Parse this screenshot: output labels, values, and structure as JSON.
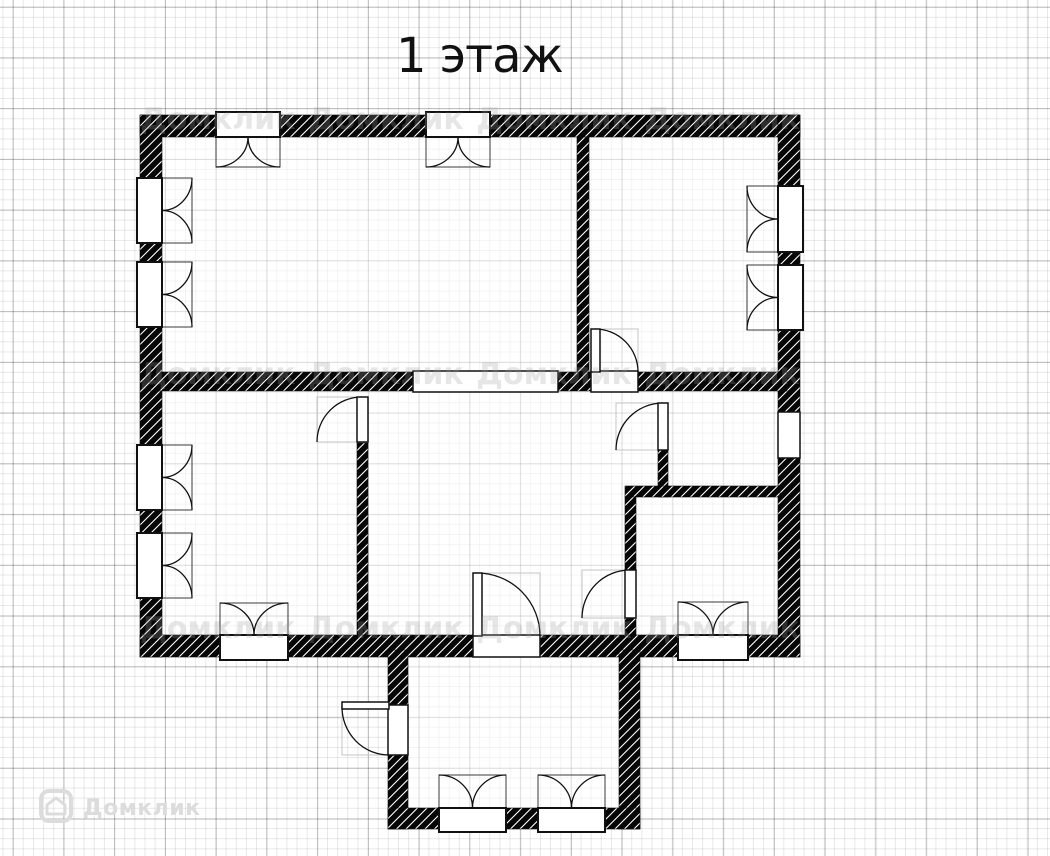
{
  "title": "1 этаж",
  "watermark": {
    "label": "Домклик"
  },
  "canvas": {
    "width": 1050,
    "height": 856
  },
  "colors": {
    "wall": "#060606",
    "hatch_line": "#ffffff",
    "line": "#111111",
    "ghost": "#c4c4c4",
    "opening_fill": "#ffffff",
    "room_overlay": "rgba(255,255,255,0.5)",
    "grid_minor": "rgba(0,0,0,0.09)",
    "grid_major": "rgba(0,0,0,0.22)",
    "title": "#111111",
    "logo": "#dcdcdc",
    "tiled_watermark": "rgba(160,160,160,0.26)"
  },
  "floorplan": {
    "footprints": [
      [
        140,
        115,
        660,
        542
      ],
      [
        388,
        650,
        252,
        179
      ]
    ],
    "walls": [
      [
        140,
        115,
        660,
        22
      ],
      [
        140,
        115,
        22,
        542
      ],
      [
        140,
        635,
        660,
        22
      ],
      [
        778,
        115,
        22,
        542
      ],
      [
        150,
        372,
        637,
        19
      ],
      [
        577,
        137,
        12,
        235
      ],
      [
        357,
        443,
        11,
        192
      ],
      [
        658,
        450,
        10,
        47
      ],
      [
        625,
        486,
        155,
        11
      ],
      [
        625,
        497,
        11,
        73
      ],
      [
        625,
        618,
        11,
        17
      ],
      [
        388,
        650,
        20,
        179
      ],
      [
        619,
        650,
        21,
        179
      ],
      [
        388,
        808,
        252,
        21
      ]
    ],
    "windows": [
      {
        "rect": [
          216,
          115,
          64,
          22
        ],
        "dir": "S",
        "depth": 30
      },
      {
        "rect": [
          426,
          115,
          64,
          22
        ],
        "dir": "S",
        "depth": 30
      },
      {
        "rect": [
          140,
          178,
          22,
          65
        ],
        "dir": "E",
        "depth": 30
      },
      {
        "rect": [
          140,
          262,
          22,
          65
        ],
        "dir": "E",
        "depth": 30
      },
      {
        "rect": [
          140,
          445,
          22,
          65
        ],
        "dir": "E",
        "depth": 30
      },
      {
        "rect": [
          140,
          533,
          22,
          65
        ],
        "dir": "E",
        "depth": 30
      },
      {
        "rect": [
          778,
          186,
          22,
          66
        ],
        "dir": "W",
        "depth": 31
      },
      {
        "rect": [
          778,
          265,
          22,
          65
        ],
        "dir": "W",
        "depth": 31
      },
      {
        "rect": [
          220,
          635,
          68,
          22
        ],
        "dir": "N",
        "depth": 32
      },
      {
        "rect": [
          678,
          635,
          70,
          22
        ],
        "dir": "N",
        "depth": 33
      },
      {
        "rect": [
          439,
          808,
          67,
          21
        ],
        "dir": "N",
        "depth": 33
      },
      {
        "rect": [
          538,
          808,
          67,
          21
        ],
        "dir": "N",
        "depth": 33
      }
    ],
    "openings": [
      [
        413,
        371,
        145,
        21
      ],
      [
        778,
        412,
        22,
        46
      ]
    ],
    "doors": [
      {
        "gap": [
          591,
          371,
          47,
          21
        ],
        "leaf": [
          591,
          329,
          9,
          43
        ],
        "arc": "M595,329 A43,43 0 0 1 638,372",
        "ghost": [
          595,
          329,
          43,
          43
        ]
      },
      {
        "leaf": [
          658,
          403,
          10,
          47
        ],
        "arc": "M663,403 A47,47 0 0 0 616,450",
        "ghost": [
          616,
          403,
          47,
          47
        ]
      },
      {
        "leaf": [
          357,
          397,
          11,
          45
        ],
        "arc": "M362,397 A45,45 0 0 0 317,442",
        "ghost": [
          317,
          397,
          45,
          45
        ]
      },
      {
        "leaf": [
          625,
          570,
          11,
          48
        ],
        "arc": "M630,570 A48,48 0 0 0 582,618",
        "ghost": [
          582,
          570,
          48,
          48
        ]
      },
      {
        "gap": [
          473,
          635,
          67,
          22
        ],
        "leaf": [
          473,
          573,
          9,
          63
        ],
        "arc": "M477,573 A63,63 0 0 1 540,636",
        "ghost": [
          477,
          573,
          63,
          63
        ]
      },
      {
        "gap": [
          388,
          705,
          20,
          50
        ],
        "leaf": [
          342,
          702,
          47,
          7
        ],
        "arc": "M342,707 A47,48 0 0 0 389,755",
        "ghost": [
          342,
          707,
          47,
          48
        ]
      }
    ]
  }
}
